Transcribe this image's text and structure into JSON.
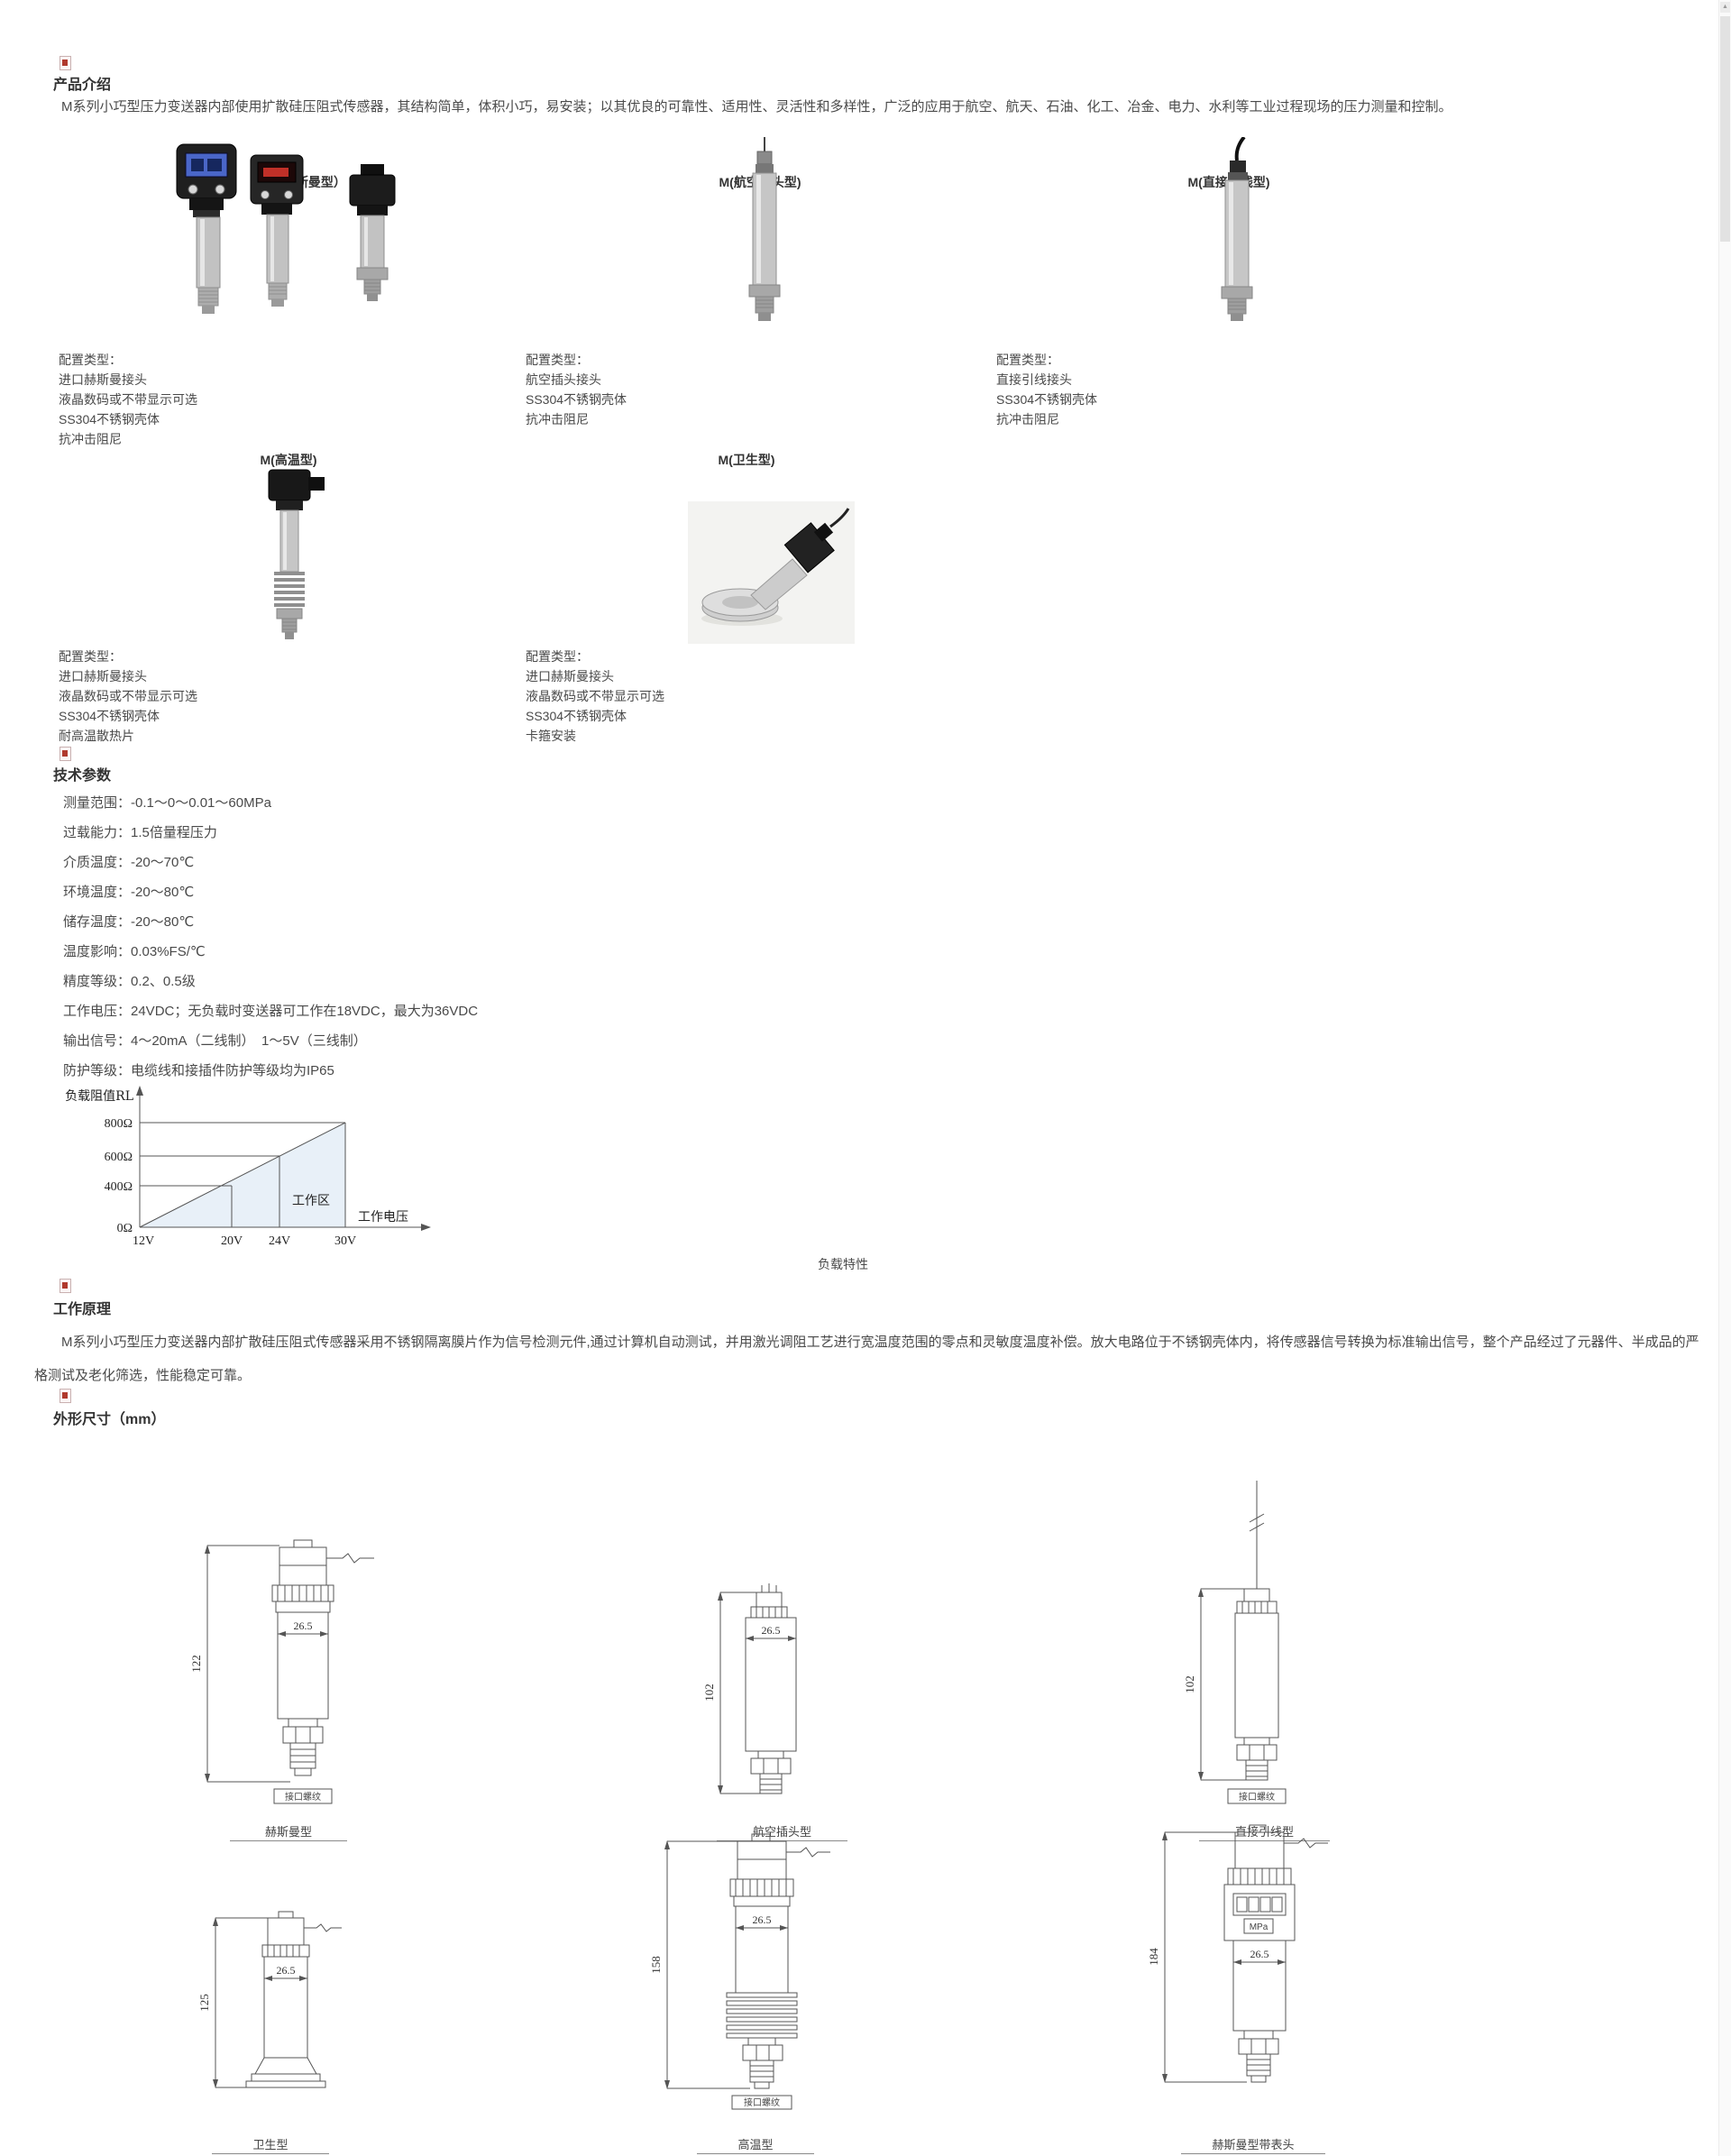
{
  "intro": {
    "heading": "产品介绍",
    "body": "M系列小巧型压力变送器内部使用扩散硅压阻式传感器，其结构简单，体积小巧，易安装；以其优良的可靠性、适用性、灵活性和多样性，广泛的应用于航空、航天、石油、化工、冶金、电力、水利等工业过程现场的压力测量和控制。"
  },
  "config_title": "配置类型：",
  "products": [
    {
      "label": "M（赫斯曼型）",
      "config": [
        "进口赫斯曼接头",
        "液晶数码或不带显示可选",
        "SS304不锈钢壳体",
        "抗冲击阻尼"
      ]
    },
    {
      "label": "M(航空插头型)",
      "config": [
        "航空插头接头",
        "SS304不锈钢壳体",
        "抗冲击阻尼"
      ]
    },
    {
      "label": "M(直接引线型)",
      "config": [
        "直接引线接头",
        "SS304不锈钢壳体",
        "抗冲击阻尼"
      ]
    },
    {
      "label": "M(高温型)",
      "config": [
        "进口赫斯曼接头",
        "液晶数码或不带显示可选",
        "SS304不锈钢壳体",
        "耐高温散热片"
      ]
    },
    {
      "label": "M(卫生型)",
      "config": [
        "进口赫斯曼接头",
        "液晶数码或不带显示可选",
        "SS304不锈钢壳体",
        "卡箍安装"
      ]
    }
  ],
  "tech": {
    "heading": "技术参数",
    "params": [
      "测量范围：-0.1～0～0.01～60MPa",
      "过载能力：1.5倍量程压力",
      "介质温度：-20～70℃",
      "环境温度：-20～80℃",
      "储存温度：-20～80℃",
      "温度影响：0.03%FS/℃",
      "精度等级：0.2、0.5级",
      "工作电压：24VDC；无负载时变送器可工作在18VDC，最大为36VDC",
      "输出信号：4～20mA（二线制）　1～5V（三线制）",
      "防护等级：电缆线和接插件防护等级均为IP65"
    ]
  },
  "chart_data": {
    "type": "area",
    "title": "负载特性",
    "ylabel": "负载阻值RL",
    "xlabel": "工作电压",
    "x_ticks": [
      "12V",
      "20V",
      "24V",
      "30V"
    ],
    "x_values": [
      12,
      20,
      24,
      30
    ],
    "y_ticks": [
      "0Ω",
      "400Ω",
      "600Ω",
      "800Ω"
    ],
    "y_values": [
      0,
      400,
      600,
      800
    ],
    "xlim": [
      12,
      30
    ],
    "ylim": [
      0,
      800
    ],
    "region_label": "工作区",
    "line_points": [
      [
        12,
        0
      ],
      [
        20,
        400
      ],
      [
        24,
        600
      ],
      [
        30,
        800
      ]
    ],
    "fill_color": "#e8f0f8",
    "grid": "partial",
    "legend": "none"
  },
  "principle": {
    "heading": "工作原理",
    "body": "M系列小巧型压力变送器内部扩散硅压阻式传感器采用不锈钢隔离膜片作为信号检测元件,通过计算机自动测试，并用激光调阻工艺进行宽温度范围的零点和灵敏度温度补偿。放大电路位于不锈钢壳体内，将传感器信号转换为标准输出信号，整个产品经过了元器件、半成品的严格测试及老化筛选，性能稳定可靠。"
  },
  "dims": {
    "heading": "外形尺寸（mm）",
    "drawings": [
      {
        "name": "赫斯曼型",
        "height_dim": "122",
        "width_dim": "26.5",
        "thread_label": "接口螺纹"
      },
      {
        "name": "航空插头型",
        "height_dim": "102",
        "width_dim": "26.5"
      },
      {
        "name": "直接引线型",
        "height_dim": "102",
        "thread_label": "接口螺纹"
      },
      {
        "name": "卫生型",
        "height_dim": "125",
        "width_dim": "26.5"
      },
      {
        "name": "高温型",
        "height_dim": "158",
        "width_dim": "26.5",
        "thread_label": "接口螺纹"
      },
      {
        "name": "赫斯曼型带表头",
        "height_dim": "184",
        "width_dim": "26.5",
        "display_label": "MPa"
      }
    ]
  }
}
